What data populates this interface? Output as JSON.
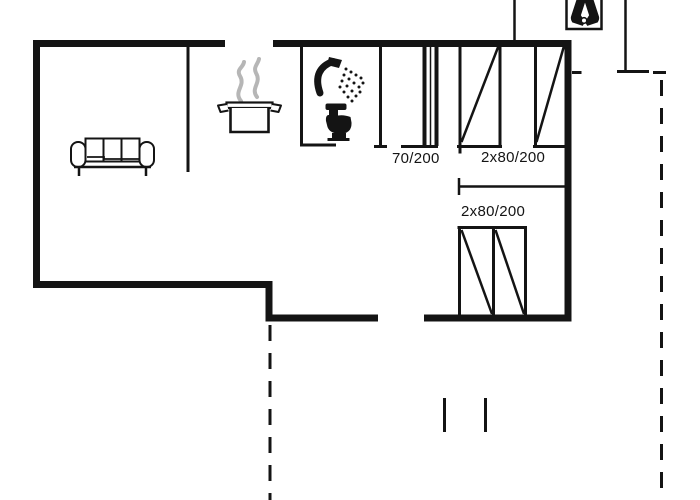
{
  "floor_plan": {
    "type": "holiday-house floor plan drawing",
    "colors": {
      "line": "#141414",
      "steam": "#b6b6b6",
      "background": "#ffffff"
    },
    "labels": {
      "interior_door": "70/200",
      "top_double_door": "2x80/200",
      "bottom_double_door": "2x80/200"
    },
    "icons": [
      {
        "name": "sofa-icon",
        "meaning": "three-seat sofa in living room"
      },
      {
        "name": "cooking-pot-icon",
        "meaning": "steaming pot marking kitchen"
      },
      {
        "name": "shower-icon",
        "meaning": "shower head with spray marking bathroom"
      },
      {
        "name": "toilet-icon",
        "meaning": "toilet marking bathroom"
      },
      {
        "name": "boots-icon",
        "meaning": "pair of boots at entrance"
      }
    ],
    "features": {
      "dashed_boundary": "terrace outline (dashed)",
      "step_marks": "two short tick marks on terrace",
      "wardrobe_panels": "door/window panels drawn with diagonals"
    }
  }
}
